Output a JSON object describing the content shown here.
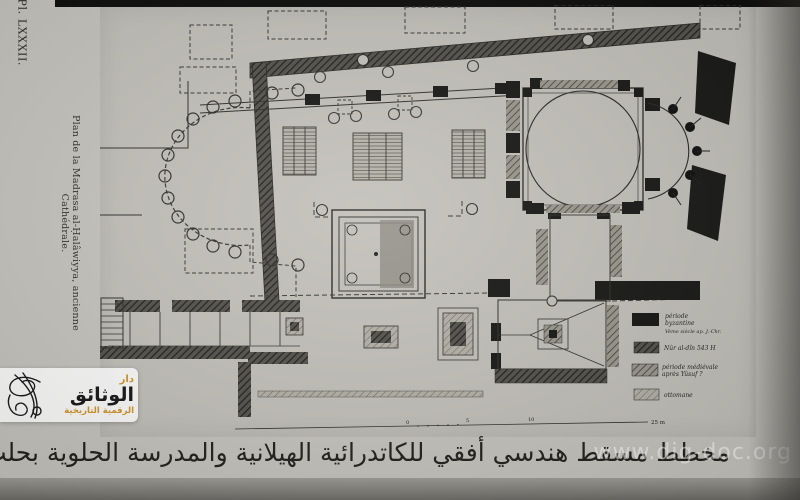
{
  "page": {
    "plate_number": "Pl. LXXXII.",
    "margin_caption_fr": "Plan de la Madrasa al-Ḥalâwiyya, ancienne Cathédrale.",
    "caption_ar": "مخطط مسقط هندسي أفقي للكاتدرائية الهيلانية والمدرسة الحلوية بحلب"
  },
  "legend": {
    "entries": [
      {
        "period": "byzantine",
        "swatch": "solid-black",
        "line1": "période",
        "line2": "byzantine",
        "line3": "Vème siècle ap. J.-Chr."
      },
      {
        "period": "nur-al-din",
        "swatch": "dark-hatch",
        "line1": "Nûr al-dîn 543 H"
      },
      {
        "period": "medieval",
        "swatch": "medium-hatch",
        "line1": "période médiévale",
        "line2": "après Yûsuf ?"
      },
      {
        "period": "ottoman",
        "swatch": "light-hatch",
        "line1": "ottomane"
      }
    ]
  },
  "scale_bar": {
    "tick0": "0",
    "tick5": "5",
    "tick10": "10",
    "end_label": "25 m"
  },
  "watermarks": {
    "url": "www.dig-doc.org",
    "logo_line1": "دار",
    "logo_line2": "الوثائق",
    "logo_line3": "الرقمية التاريخية"
  },
  "colors": {
    "accent_gold": "#d4942c",
    "paper": "#c7c5bf",
    "ink": "#26251f"
  }
}
